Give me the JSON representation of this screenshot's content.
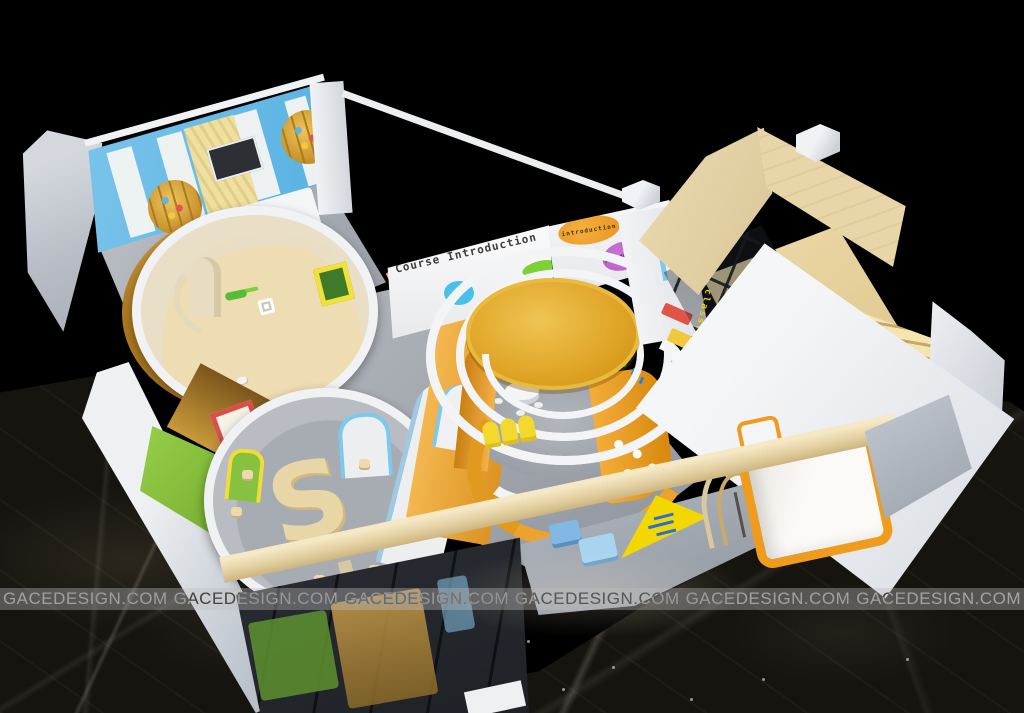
{
  "texts": {
    "wall_title": "Course Introduction",
    "bubble_orange": "introduction",
    "bubble_purple": "introduction",
    "glass_label": "classrooms",
    "sdesk_glyph": "S"
  },
  "watermark": {
    "label": "GACEDESIGN.COM",
    "items": [
      "GACEDESIGN.COM",
      "GACEDESIGN.COM",
      "GACEDESIGN.COM",
      "GACEDESIGN.COM",
      "GACEDESIGN.COM",
      "GACEDESIGN.COM"
    ]
  },
  "palette": {
    "background": "#000000",
    "marble_floor": "#16140f",
    "wood_light": "#ead9b2",
    "wall_white": "#f1f2f4",
    "accent_orange": "#efa52e",
    "canopy_orange": "#dda122",
    "accent_yellow": "#f3d92e",
    "accent_blue": "#6cc0ea",
    "accent_green": "#8cc43e",
    "accent_purple": "#c264cc",
    "accent_red": "#e05548",
    "floor_gray": "#9aa0a7",
    "glass_dark": "#26292e",
    "sign_yellow": "#f2d800",
    "sign_text_blue": "#2b6fd4",
    "glass_text_yellow": "#f2cf00"
  }
}
